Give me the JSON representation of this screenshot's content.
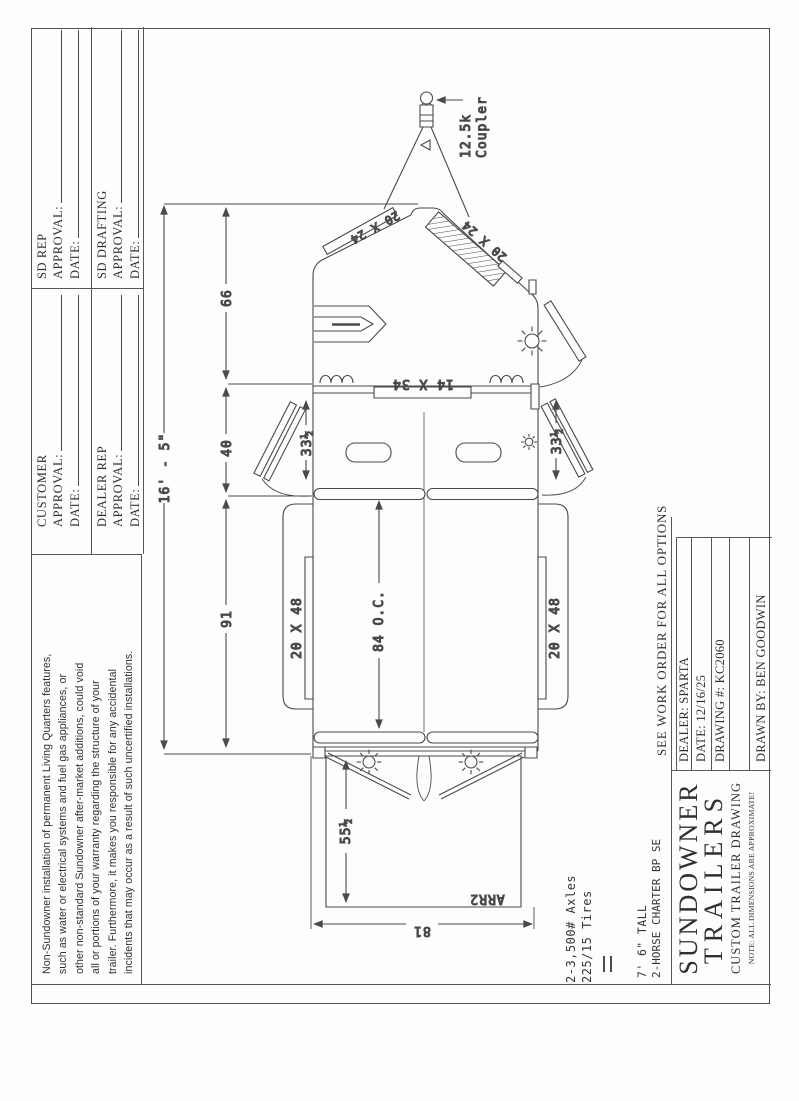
{
  "colors": {
    "ink": "#4a4a4a",
    "text": "#303030",
    "paper": "#fdfdfc"
  },
  "disclaimer": {
    "lines": [
      "Non-Sundowner installation of permanent Living Quarters features,",
      "such as water or electrical systems and fuel gas appliances, or",
      "other non-standard Sundowner after-market additions, could void",
      "all or portions of your warranty regarding the structure of your",
      "trailer. Furthermore, it makes you responsible for any accidental",
      "incidents that may occur as a result of such uncertified installations."
    ]
  },
  "approvals": {
    "approval_label": "APPROVAL:",
    "date_label": "DATE:",
    "blocks": [
      {
        "name": "CUSTOMER"
      },
      {
        "name": "SD REP"
      },
      {
        "name": "DEALER REP"
      },
      {
        "name": "SD DRAFTING"
      }
    ]
  },
  "order_block": {
    "banner": "SEE WORK ORDER FOR ALL OPTIONS",
    "rows": [
      "DEALER: SPARTA",
      "DATE: 12/16/25",
      "DRAWING #: KC2060",
      "",
      "DRAWN BY: BEN GOODWIN"
    ]
  },
  "title_block": {
    "brand_line1": "SUNDOWNER",
    "brand_line2": "TRAILERS",
    "subtitle": "CUSTOM TRAILER DRAWING",
    "note": "NOTE: ALL DIMENSIONS ARE APPROXIMATE!"
  },
  "specs": {
    "axles": "2-3,500# Axles",
    "tires": "225/15 Tires",
    "height": "7' 6\" TALL",
    "model": "2-HORSE CHARTER BP SE"
  },
  "dimensions": {
    "overall_length": "16' - 5\"",
    "nose_length": "66",
    "dress_length": "40",
    "stall_length": "91",
    "stall_spacing": "84 O.C.",
    "rear_width": "81",
    "ramp_length": "55½",
    "nose_window": "20 X 24",
    "side_window": "20 X 48",
    "bulkhead_window": "14 X 34",
    "drop_window": "33½",
    "coupler_line1": "12.5k",
    "coupler_line2": "Coupler",
    "ramp_code": "ARR2"
  }
}
